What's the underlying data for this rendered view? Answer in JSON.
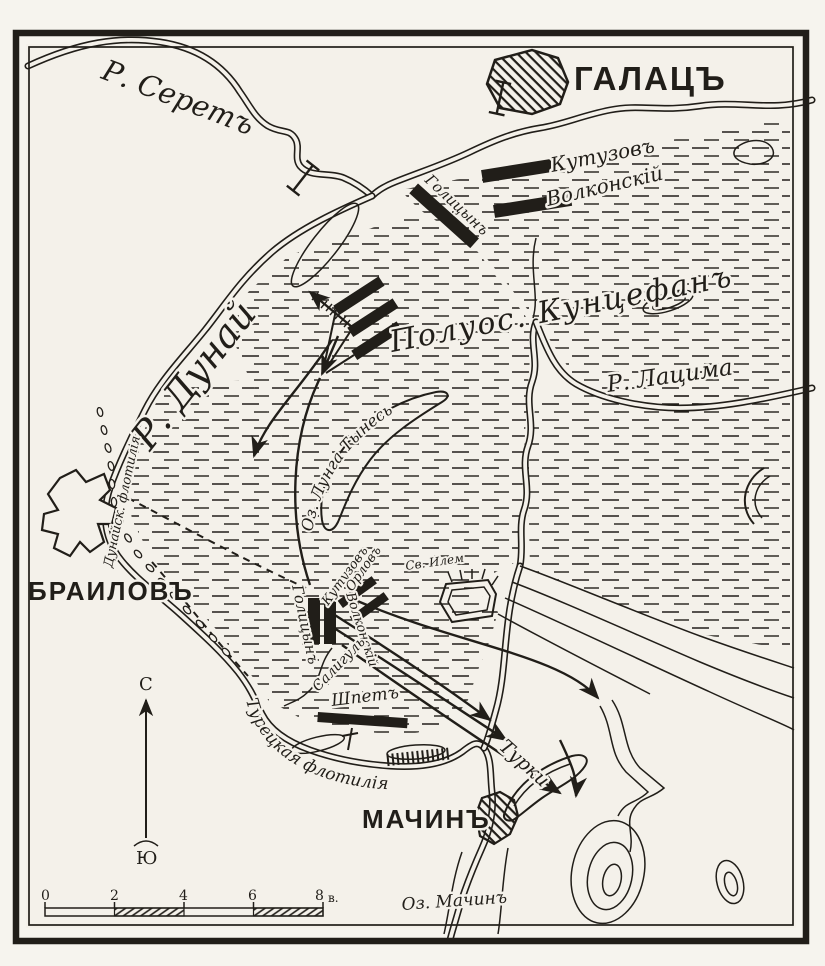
{
  "labels": {
    "river_seret": "Р. Серетъ",
    "city_galats": "ГАЛАЦЪ",
    "unit_kutuzov_north": "Кутузовъ",
    "unit_volkonsky_north": "Волконскій",
    "unit_golitsyn_north": "Голицынъ",
    "peninsula_kuntsefan": "Полуос. Кунцефанъ",
    "river_latsima": "Р. Лацима",
    "river_dunay": "Р. Дунай",
    "lake_lunga_tynes": "Оз. Лунга Тынесь",
    "danube_flotilla": "Дунайск. флотилія",
    "city_brailov": "БРАИЛОВЪ",
    "unit_golitsyn_center": "Голицынъ",
    "unit_kutuzov_center": "Кутузовъ",
    "unit_volkonsky_center": "Волконскій",
    "unit_orlov": "Орловъ",
    "fort_sv_ilem": "Св. Илем",
    "stream_saligul": "Салигуль",
    "unit_shpet": "Шпетъ",
    "turkish_flotilla": "Турецкая флотилія",
    "city_machin": "МАЧИНЪ",
    "unit_turki": "Турки",
    "lake_machin": "Оз. Мачинъ",
    "compass_north": "С",
    "compass_south": "Ю"
  },
  "scale_bar": {
    "ticks": [
      "0",
      "2",
      "4",
      "6",
      "8"
    ],
    "unit_label": "в."
  },
  "colors": {
    "ink": "#211e19",
    "paper": "#f4f1ea"
  }
}
